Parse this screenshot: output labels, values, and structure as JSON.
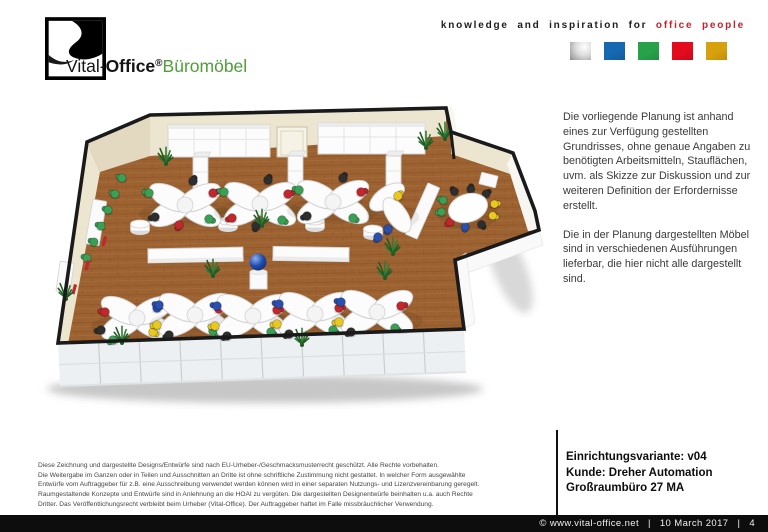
{
  "header": {
    "logo": {
      "brand": "Vital-",
      "brand_bold": "Office",
      "reg": "®",
      "suffix": "Büromöbel",
      "green": "#4f9e3b"
    },
    "tagline": {
      "black": "knowledge and inspiration for",
      "red": "office people",
      "red_color": "#c5202c"
    },
    "palette": [
      {
        "name": "silver-square",
        "silver": true
      },
      {
        "name": "blue-square",
        "color": "#1668b1"
      },
      {
        "name": "green-square",
        "color": "#27a24b"
      },
      {
        "name": "red-square",
        "color": "#e30b1d"
      },
      {
        "name": "gold-square",
        "color": "#d7a00d"
      }
    ]
  },
  "side_text": {
    "para1": "Die vorliegende  Planung ist anhand\neines zur Verfügung  gestellten\nGrundrisses,  ohne genaue  Angaben zu\nbenötigten Arbeitsmitteln,  Stauflächen,\nuvm.  als Skizze zur Diskussion und zur\nweiteren  Definition  der Erfordernisse\nerstellt.",
    "para2": "Die in der Planung  dargestellten  Möbel\nsind in verschiedenen   Ausführungen\nlieferbar,  die hier nicht alle dargestellt\nsind."
  },
  "info_block": {
    "line1": "Einrichtungsvariante: v04",
    "line2": "Kunde: Dreher Automation",
    "line3": "Großraumbüro 27 MA"
  },
  "legal": {
    "text": "Diese Zeichnung und dargestellte Designs/Entwürfe sind nach EU-Urheber-/Geschmacksmusterrecht geschützt. Alle Rechte vorbehalten.\nDie Weitergabe im Ganzen oder in Teilen und Ausschnitten an Dritte ist ohne schriftliche Zustimmung nicht gestattet. In welcher Form ausgewählte\nEntwürfe vom Auftraggeber für z.B. eine Ausschreibung verwendet werden können wird in einer separaten Nutzungs- und Lizenzvereinbarung geregelt.\nRaumgestaltende Konzepte und Entwürfe sind in Anlehnung an die HOAI zu vergüten. Die dargestellten Designentwürfe beinhalten u.a. auch Rechte\nDritter. Das Veröffentlichungsrecht verbleibt beim Urheber (Vital-Office). Der Auftraggeber haftet im Falle missbräuchlicher Verwendung."
  },
  "footer": {
    "copyright": "©  www.vital-office.net",
    "sep": "|",
    "date": "10 March 2017",
    "page": "4"
  },
  "floorplan": {
    "colors": {
      "outline": "#1a1a1a",
      "floor": "#9d6231",
      "floor_dark": "#8a5124",
      "floor_light": "#b07a45",
      "wall_beige": "#ece5d0",
      "wall_beige_dark": "#e2d9c0",
      "wall_white": "#f7f6f1",
      "glass": "#edf0f2",
      "mullion": "#c9ced2",
      "frame": "#dfe3e6",
      "furn": "#fcfcfc",
      "furn_edge": "#d2d2d2",
      "furn_shade": "#ebebeb",
      "plant": "#2f7c33",
      "plant_dark": "#215c25",
      "sphere": "#1f4cb0",
      "sphere_hi": "#8fb0ec",
      "chairs": {
        "red": "#c1272d",
        "blue": "#2a4fae",
        "green": "#3aa055",
        "yellow": "#e9c81f",
        "black": "#2e2e2e"
      }
    },
    "outline": [
      [
        120,
        17
      ],
      [
        416,
        10
      ],
      [
        421,
        34
      ],
      [
        483,
        55
      ],
      [
        505,
        113
      ],
      [
        509,
        132
      ],
      [
        425,
        162
      ],
      [
        434,
        231
      ],
      [
        28,
        245
      ],
      [
        57,
        44
      ]
    ],
    "beige_faces": [
      {
        "pts": [
          [
            120,
            17
          ],
          [
            416,
            10
          ],
          [
            416,
            38
          ],
          [
            120,
            58
          ]
        ],
        "fill": "wall_beige"
      },
      {
        "pts": [
          [
            57,
            44
          ],
          [
            120,
            17
          ],
          [
            120,
            58
          ],
          [
            70,
            74
          ]
        ],
        "fill": "wall_beige_dark"
      },
      {
        "pts": [
          [
            57,
            44
          ],
          [
            70,
            74
          ],
          [
            38,
            246
          ],
          [
            28,
            245
          ]
        ],
        "fill": "wall_beige"
      },
      {
        "pts": [
          [
            421,
            34
          ],
          [
            483,
            55
          ],
          [
            480,
            76
          ],
          [
            421,
            56
          ]
        ],
        "fill": "wall_beige"
      },
      {
        "pts": [
          [
            483,
            55
          ],
          [
            505,
            113
          ],
          [
            509,
            132
          ],
          [
            498,
            133
          ],
          [
            477,
            66
          ]
        ],
        "fill": "wall_white"
      },
      {
        "pts": [
          [
            416,
            10
          ],
          [
            421,
            34
          ],
          [
            427,
            31
          ],
          [
            422,
            8
          ]
        ],
        "fill": "wall_white"
      }
    ],
    "outer_faces": [
      {
        "pts": [
          [
            425,
            162
          ],
          [
            509,
            132
          ],
          [
            513,
            147
          ],
          [
            429,
            178
          ]
        ]
      },
      {
        "pts": [
          [
            425,
            162
          ],
          [
            434,
            231
          ],
          [
            445,
            225
          ],
          [
            436,
            155
          ]
        ]
      }
    ],
    "glass": {
      "pts": [
        [
          28,
          245
        ],
        [
          434,
          233
        ],
        [
          436,
          274
        ],
        [
          30,
          288
        ]
      ],
      "mullions": 9
    },
    "cabinets": [
      {
        "x": 138,
        "y": 27,
        "w": 102,
        "h": 32
      },
      {
        "x": 288,
        "y": 25,
        "w": 107,
        "h": 31
      }
    ],
    "door": {
      "x": 247,
      "y": 29,
      "w": 30,
      "h": 30
    },
    "tall_boxes": [
      [
        163,
        59
      ],
      [
        258,
        58
      ],
      [
        356,
        58
      ]
    ],
    "drums": [
      [
        110,
        129
      ],
      [
        198,
        126
      ],
      [
        285,
        126
      ],
      [
        343,
        134
      ]
    ],
    "mid_boards": [
      {
        "x": 118,
        "y": 150,
        "w": 95,
        "h": 14,
        "r": -1
      },
      {
        "x": 243,
        "y": 149,
        "w": 76,
        "h": 14,
        "r": 1
      }
    ],
    "wall_boxes": [
      {
        "x": 59,
        "y": 102,
        "w": 14,
        "h": 45,
        "r": 10
      },
      {
        "x": 28,
        "y": 164,
        "w": 14,
        "h": 30,
        "r": 8
      },
      {
        "x": 386,
        "y": 85,
        "w": 13,
        "h": 56,
        "r": 24
      },
      {
        "x": 450,
        "y": 76,
        "w": 17,
        "h": 12,
        "r": 14
      }
    ],
    "sphere": {
      "x": 228,
      "y": 164,
      "r": 8.5,
      "ped": [
        220,
        174,
        17,
        17
      ]
    },
    "clusters": [
      {
        "x": 155,
        "y": 107,
        "chairs": [
          [
            -36,
            -12,
            "green"
          ],
          [
            8,
            -24,
            "black"
          ],
          [
            28,
            -12,
            "red"
          ],
          [
            -30,
            12,
            "black"
          ],
          [
            24,
            14,
            "green"
          ],
          [
            -6,
            20,
            "red"
          ]
        ]
      },
      {
        "x": 230,
        "y": 106,
        "chairs": [
          [
            -36,
            -12,
            "green"
          ],
          [
            8,
            -24,
            "black"
          ],
          [
            28,
            -10,
            "red"
          ],
          [
            -28,
            14,
            "red"
          ],
          [
            22,
            16,
            "green"
          ],
          [
            -4,
            22,
            "black"
          ]
        ]
      },
      {
        "x": 303,
        "y": 104,
        "chairs": [
          [
            -34,
            -12,
            "green"
          ],
          [
            10,
            -24,
            "black"
          ],
          [
            28,
            -10,
            "red"
          ],
          [
            -26,
            14,
            "black"
          ],
          [
            20,
            16,
            "green"
          ]
        ]
      },
      {
        "x": 107,
        "y": 220,
        "chairs": [
          [
            -32,
            -6,
            "red"
          ],
          [
            -36,
            12,
            "black"
          ],
          [
            -24,
            22,
            "green"
          ],
          [
            20,
            -10,
            "blue"
          ],
          [
            16,
            14,
            "yellow"
          ]
        ]
      },
      {
        "x": 165,
        "y": 217,
        "chairs": [
          [
            -36,
            -10,
            "blue"
          ],
          [
            -38,
            10,
            "yellow"
          ],
          [
            -26,
            20,
            "black"
          ],
          [
            24,
            -6,
            "red"
          ],
          [
            18,
            16,
            "green"
          ]
        ]
      },
      {
        "x": 223,
        "y": 218,
        "chairs": [
          [
            -36,
            -10,
            "blue"
          ],
          [
            -38,
            10,
            "yellow"
          ],
          [
            -26,
            20,
            "black"
          ],
          [
            24,
            -6,
            "red"
          ],
          [
            18,
            16,
            "green"
          ]
        ]
      },
      {
        "x": 285,
        "y": 216,
        "chairs": [
          [
            -36,
            -10,
            "blue"
          ],
          [
            -38,
            10,
            "yellow"
          ],
          [
            -26,
            20,
            "black"
          ],
          [
            24,
            -6,
            "red"
          ],
          [
            18,
            16,
            "green"
          ]
        ]
      },
      {
        "x": 347,
        "y": 214,
        "chairs": [
          [
            -36,
            -10,
            "blue"
          ],
          [
            -38,
            10,
            "yellow"
          ],
          [
            -26,
            20,
            "black"
          ],
          [
            24,
            -6,
            "red"
          ],
          [
            18,
            16,
            "green"
          ]
        ]
      }
    ],
    "small_cluster": {
      "x": 363,
      "y": 105,
      "chairs": [
        [
          5,
          -7,
          "yellow"
        ],
        [
          -5,
          26,
          "blue"
        ],
        [
          -15,
          34,
          "blue"
        ]
      ]
    },
    "conference": {
      "x": 438,
      "y": 110,
      "trx": 20,
      "tryy": 14,
      "rot": -18,
      "ring": [
        27,
        19
      ],
      "chairs": [
        "black",
        "black",
        "black",
        "yellow",
        "yellow",
        "black",
        "blue",
        "red",
        "green",
        "green"
      ]
    },
    "green_row": {
      "start": [
        92,
        80
      ],
      "step": [
        -7,
        16
      ],
      "n": 6
    },
    "red_bars": [
      [
        74,
        138
      ],
      [
        57,
        162
      ],
      [
        44,
        186
      ]
    ],
    "plants": [
      [
        136,
        65
      ],
      [
        232,
        127
      ],
      [
        183,
        177
      ],
      [
        415,
        40
      ],
      [
        396,
        49
      ],
      [
        363,
        155
      ],
      [
        355,
        179
      ],
      [
        92,
        244
      ],
      [
        272,
        246
      ],
      [
        36,
        200
      ]
    ]
  }
}
